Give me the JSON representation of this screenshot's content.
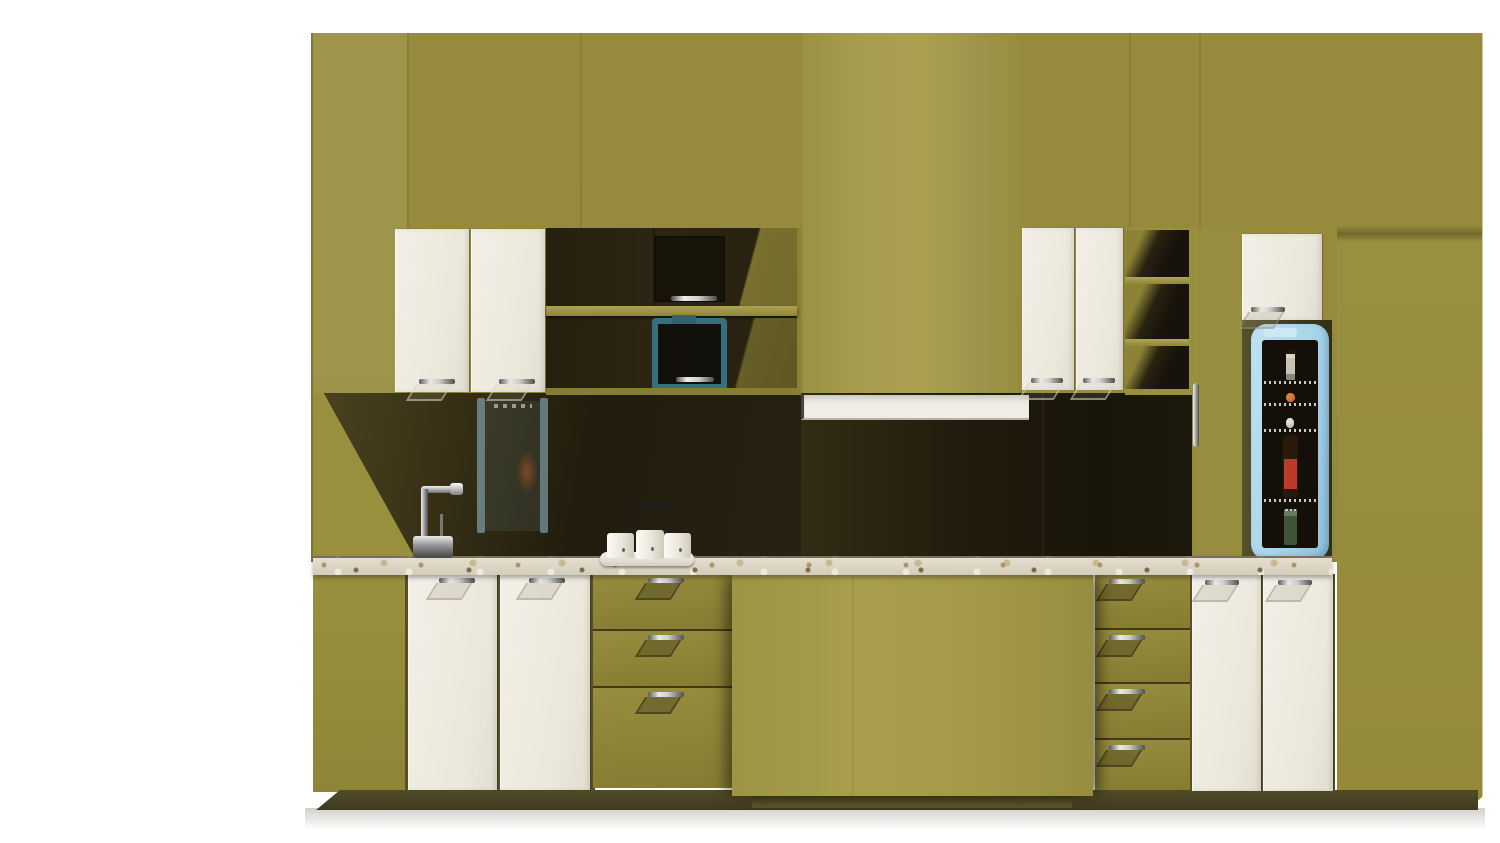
{
  "scene": {
    "description": "3D product render of a modern high-gloss olive-green kitchen wall unit on a white background",
    "objects": [
      "kitchen-wall-unit",
      "wall-cabinet-doors-left",
      "glass-display-cabinet",
      "built-in-coffee-machine",
      "range-hood-chimney",
      "range-hood",
      "wall-cabinet-doors-right",
      "open-shelf-unit",
      "pantry-column",
      "beverage-fridge",
      "fridge-bottles",
      "countertop",
      "faucet",
      "kettle-set",
      "base-cabinet-doors-left",
      "drawer-bank-three",
      "kitchen-island",
      "drawer-stack-four",
      "base-cabinet-doors-right",
      "toe-kick"
    ]
  },
  "palette": {
    "bg": "#ffffff",
    "greenBase": "#99903e",
    "greenLight": "#a59c50",
    "greenMid": "#968b3c",
    "greenDrawer": "#8d8435",
    "greenIsland": "#a29947",
    "darkGlass": "#231d0e",
    "offWhite": "#eeeae1",
    "counterBase": "#dbd3c2",
    "counterSpeck1": "#b09468",
    "counterSpeck2": "#7d6b4e",
    "toeKick": "#4a4523",
    "fridgeBlue": "#a8d4e9",
    "fridgeInterior": "#140f08",
    "tealAppliance": "#35707e",
    "bottleGreen": "#4d8a3d",
    "labelRed": "#bb3a2a",
    "orangeJar": "#b85a1e",
    "reflectionBlue": "#91c3d7",
    "chrome": "#cfcfcd"
  },
  "fridge": {
    "rows": [
      {
        "top": 6,
        "height": 34,
        "items": [
          "gray-bottle",
          "gray-bottle",
          "gray-bottle",
          "gray-bottle"
        ]
      },
      {
        "top": 46,
        "height": 16,
        "items": [
          "orange",
          "orange",
          "orange",
          "orange",
          "orange",
          "orange"
        ]
      },
      {
        "top": 68,
        "height": 20,
        "items": [
          "egg",
          "egg",
          "egg",
          "egg",
          "egg",
          "egg"
        ]
      },
      {
        "top": 93,
        "height": 64,
        "items": [
          "small-dark",
          "green-bottle",
          "green-bottle",
          "red-bottle"
        ]
      },
      {
        "top": 163,
        "height": 42,
        "items": [
          "jar",
          "jar",
          "jar"
        ]
      }
    ],
    "shelf_lines": [
      41,
      63,
      89,
      159
    ]
  }
}
